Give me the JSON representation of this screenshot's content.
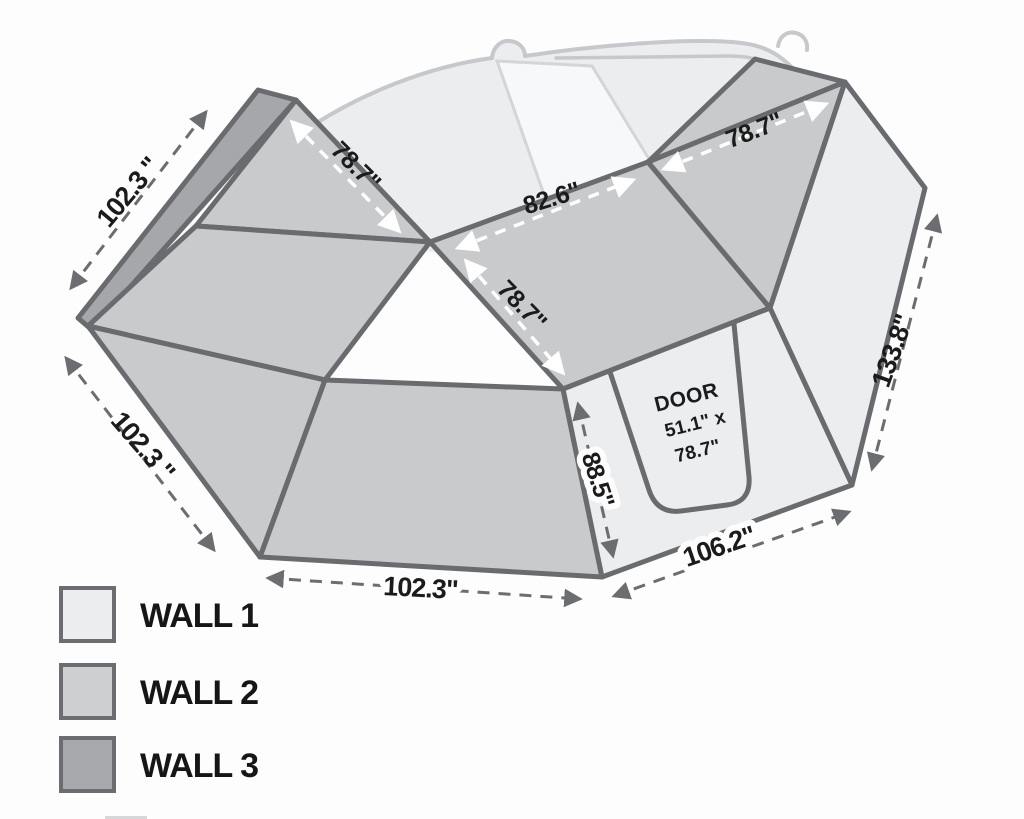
{
  "colors": {
    "wall1": "#ebedee",
    "wall2": "#c8cacc",
    "wall3": "#a5a7aa",
    "outline": "#696b6e",
    "dim_arrow": "#6b6d70",
    "white_arrow": "#ffffff",
    "vehicle_fill": "#ecedef",
    "windshield_fill": "#f7f8fa"
  },
  "legend": {
    "items": [
      {
        "label": "WALL 1",
        "color": "#ebedee"
      },
      {
        "label": "WALL 2",
        "color": "#cdcfd1"
      },
      {
        "label": "WALL 3",
        "color": "#a6a8ab"
      }
    ]
  },
  "door": {
    "title": "DOOR",
    "size_line1": "51.1\" x",
    "size_line2": "78.7\""
  },
  "dims": {
    "top_left": "102.3 \"",
    "left": "102.3 \"",
    "bottom": "102.3\"",
    "bottom_right": "106.2\"",
    "right_side": "133.8\"",
    "door_height": "88.5\""
  },
  "roof_dims": {
    "left": "78.7\"",
    "mid": "82.6\"",
    "center": "78.7\"",
    "right": "78.7\""
  }
}
